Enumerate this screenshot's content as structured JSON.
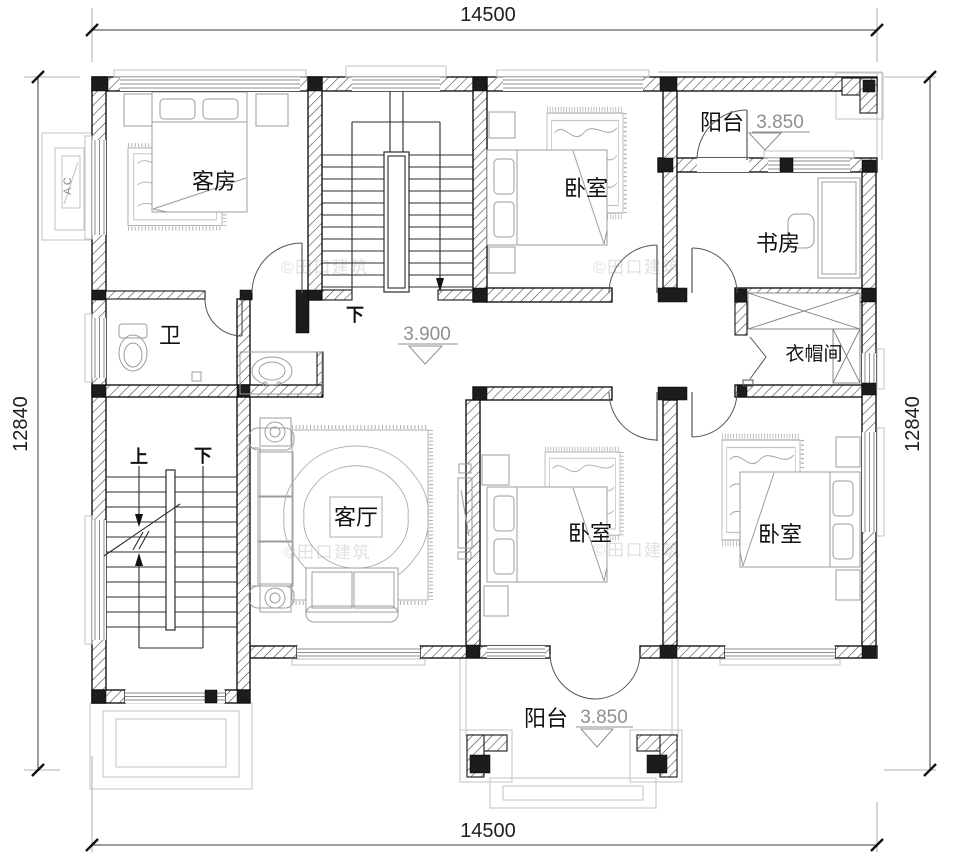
{
  "dimensions": {
    "top": "14500",
    "bottom": "14500",
    "left": "12840",
    "right": "12840"
  },
  "rooms": {
    "guest_room": "客房",
    "bedroom_top": "卧室",
    "study": "书房",
    "bathroom": "卫",
    "cloakroom": "衣帽间",
    "living_room": "客厅",
    "bedroom_mid": "卧室",
    "bedroom_right": "卧室",
    "balcony_top": "阳台",
    "balcony_bottom": "阳台"
  },
  "levels": {
    "hall": "3.900",
    "balcony_top": "3.850",
    "balcony_bottom": "3.850"
  },
  "stairs": {
    "up": "上",
    "down": "下"
  },
  "annotations": {
    "ac_label": "A C",
    "watermark": "©田口建筑"
  }
}
